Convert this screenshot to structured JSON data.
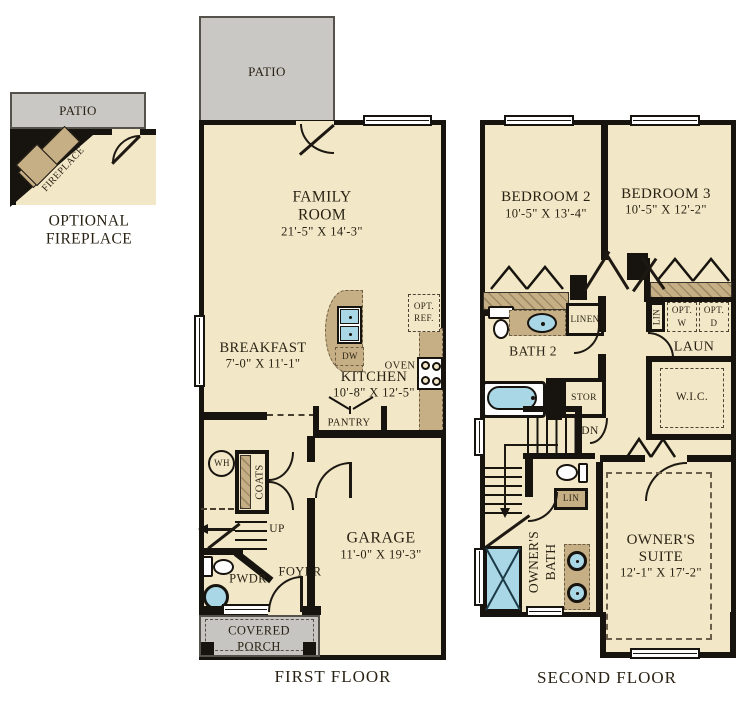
{
  "colors": {
    "floor": "#f2e8c7",
    "patio": "#c9c8c4",
    "porch": "#c6c5c1",
    "cabinet": "#c6af85",
    "fixture_blue": "#a9d7e6",
    "wall": "#17130e",
    "text": "#2a2315"
  },
  "detail": {
    "patio": "PATIO",
    "fireplace": "FIREPLACE",
    "caption1": "OPTIONAL",
    "caption2": "FIREPLACE"
  },
  "ff": {
    "caption": "FIRST FLOOR",
    "patio": "PATIO",
    "family": {
      "l1": "FAMILY",
      "l2": "ROOM",
      "dims": "21'-5\" X 14'-3\""
    },
    "breakfast": {
      "name": "BREAKFAST",
      "dims": "7'-0\" X 11'-1\""
    },
    "kitchen": {
      "name": "KITCHEN",
      "dims": "10'-8\" X 12'-5\""
    },
    "garage": {
      "name": "GARAGE",
      "dims": "11'-0\" X 19'-3\""
    },
    "optref1": "OPT.",
    "optref2": "REF.",
    "oven": "OVEN",
    "dw": "DW",
    "pantry": "PANTRY",
    "coats": "COATS",
    "wh": "WH",
    "up": "UP",
    "pwdr": "PWDR",
    "foyer": "FOYER",
    "porch1": "COVERED",
    "porch2": "PORCH"
  },
  "sf": {
    "caption": "SECOND FLOOR",
    "bedroom2": {
      "name": "BEDROOM 2",
      "dims": "10'-5\" X 13'-4\""
    },
    "bedroom3": {
      "name": "BEDROOM 3",
      "dims": "10'-5\" X 12'-2\""
    },
    "suite": {
      "l1": "OWNER'S",
      "l2": "SUITE",
      "dims": "12'-1\" X 17'-2\""
    },
    "bath2": "BATH 2",
    "linen": "LINEN",
    "lin_u": "LIN",
    "optw1": "OPT.",
    "optw2": "W",
    "optd1": "OPT.",
    "optd2": "D",
    "laun": "LAUN",
    "stor": "STOR",
    "wic": "W.I.C.",
    "dn": "DN",
    "lin_l": "LIN",
    "obath1": "OWNER'S",
    "obath2": "BATH"
  }
}
